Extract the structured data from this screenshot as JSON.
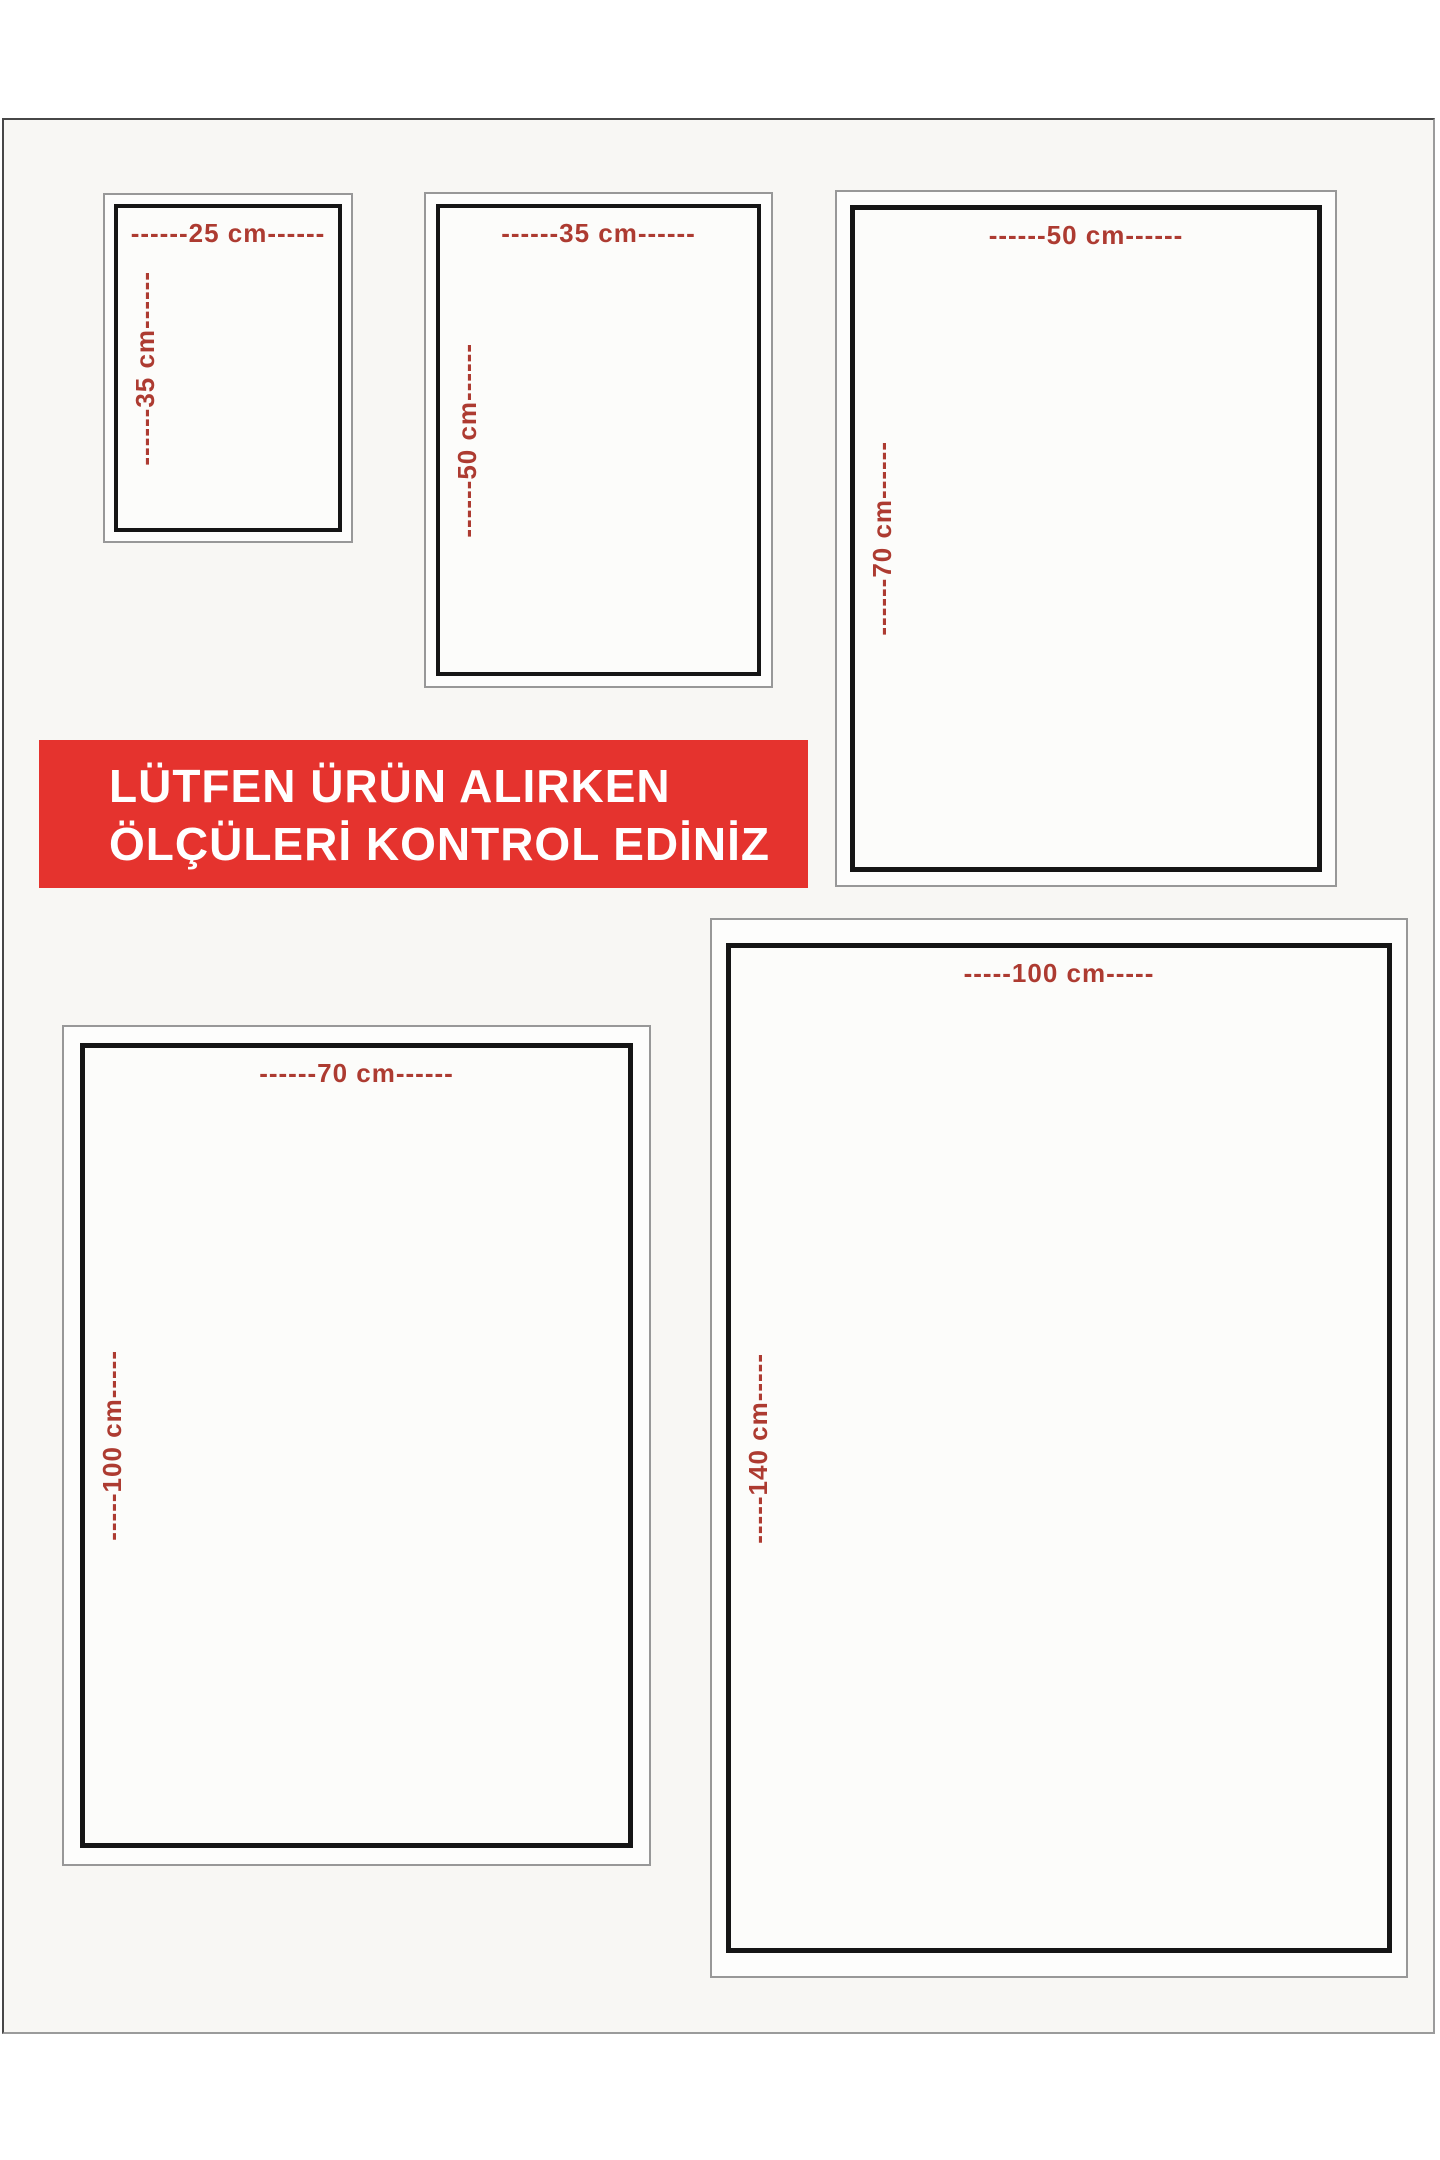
{
  "banner": {
    "line1": "LÜTFEN ÜRÜN ALIRKEN",
    "line2": "ÖLÇÜLERİ KONTROL EDİNİZ",
    "background_color": "#e5332e",
    "text_color": "#ffffff"
  },
  "cards": [
    {
      "id": "25x35",
      "width_cm": 25,
      "height_cm": 35,
      "width_label": "------25 cm------",
      "height_label": "------35 cm------"
    },
    {
      "id": "35x50",
      "width_cm": 35,
      "height_cm": 50,
      "width_label": "------35 cm------",
      "height_label": "------50 cm------"
    },
    {
      "id": "50x70",
      "width_cm": 50,
      "height_cm": 70,
      "width_label": "------50 cm------",
      "height_label": "------70 cm------"
    },
    {
      "id": "70x100",
      "width_cm": 70,
      "height_cm": 100,
      "width_label": "------70 cm------",
      "height_label": "-----100 cm-----"
    },
    {
      "id": "100x140",
      "width_cm": 100,
      "height_cm": 140,
      "width_label": "-----100 cm-----",
      "height_label": "-----140 cm-----"
    }
  ],
  "colors": {
    "dimension_text": "#ad3b31",
    "card_border_outer": "#989898",
    "card_border_inner": "#151515",
    "page_background": "#f8f7f4"
  }
}
